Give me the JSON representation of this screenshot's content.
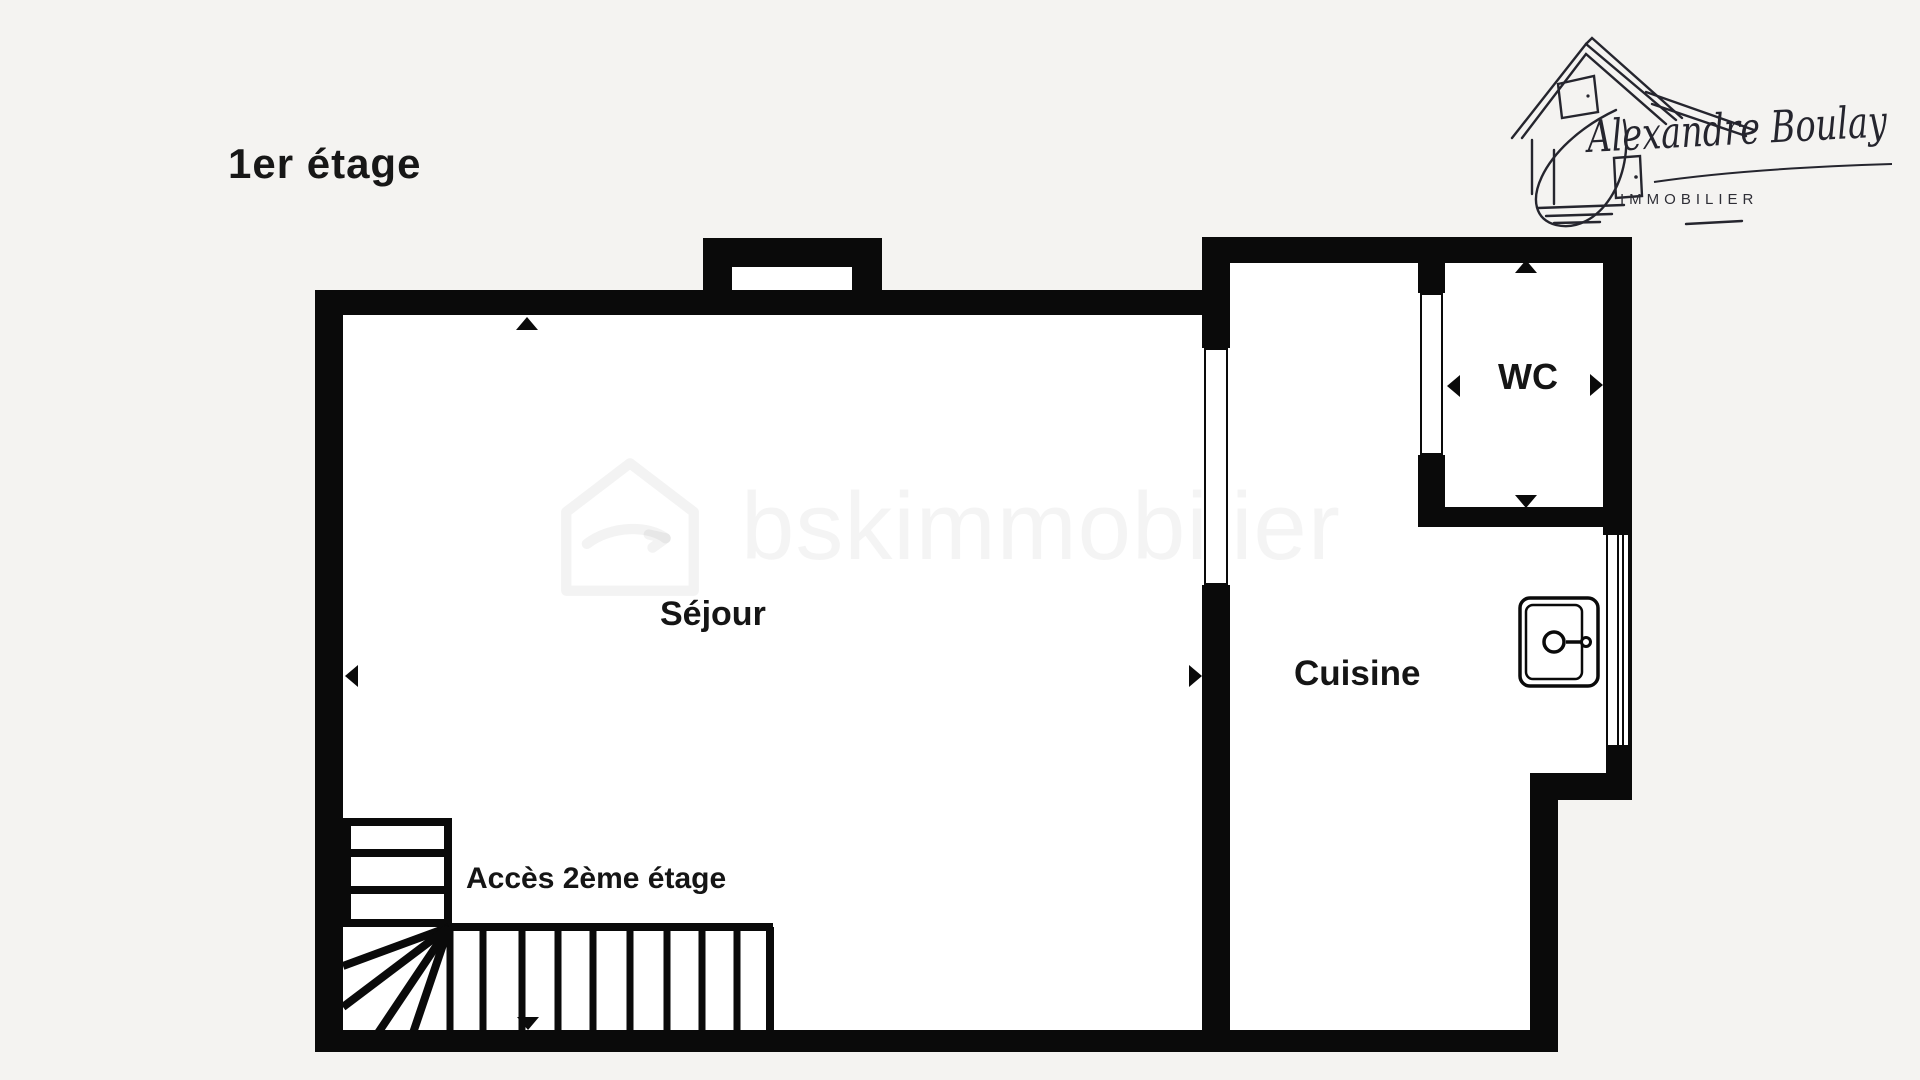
{
  "page": {
    "title": "1er étage"
  },
  "logo": {
    "name": "Alexandre Boulay",
    "subtitle": "IMMOBILIER"
  },
  "watermark": {
    "text": "bskimmobilier"
  },
  "floorplan": {
    "rooms": {
      "sejour": {
        "label": "Séjour"
      },
      "cuisine": {
        "label": "Cuisine"
      },
      "wc": {
        "label": "WC"
      }
    },
    "stairs": {
      "label": "Accès 2ème étage"
    }
  },
  "colors": {
    "background": "#f4f3f1",
    "wall": "#0a0a0a",
    "room_fill": "#ffffff",
    "logo_ink": "#25252e",
    "watermark": "rgba(10,10,10,0.045)"
  }
}
